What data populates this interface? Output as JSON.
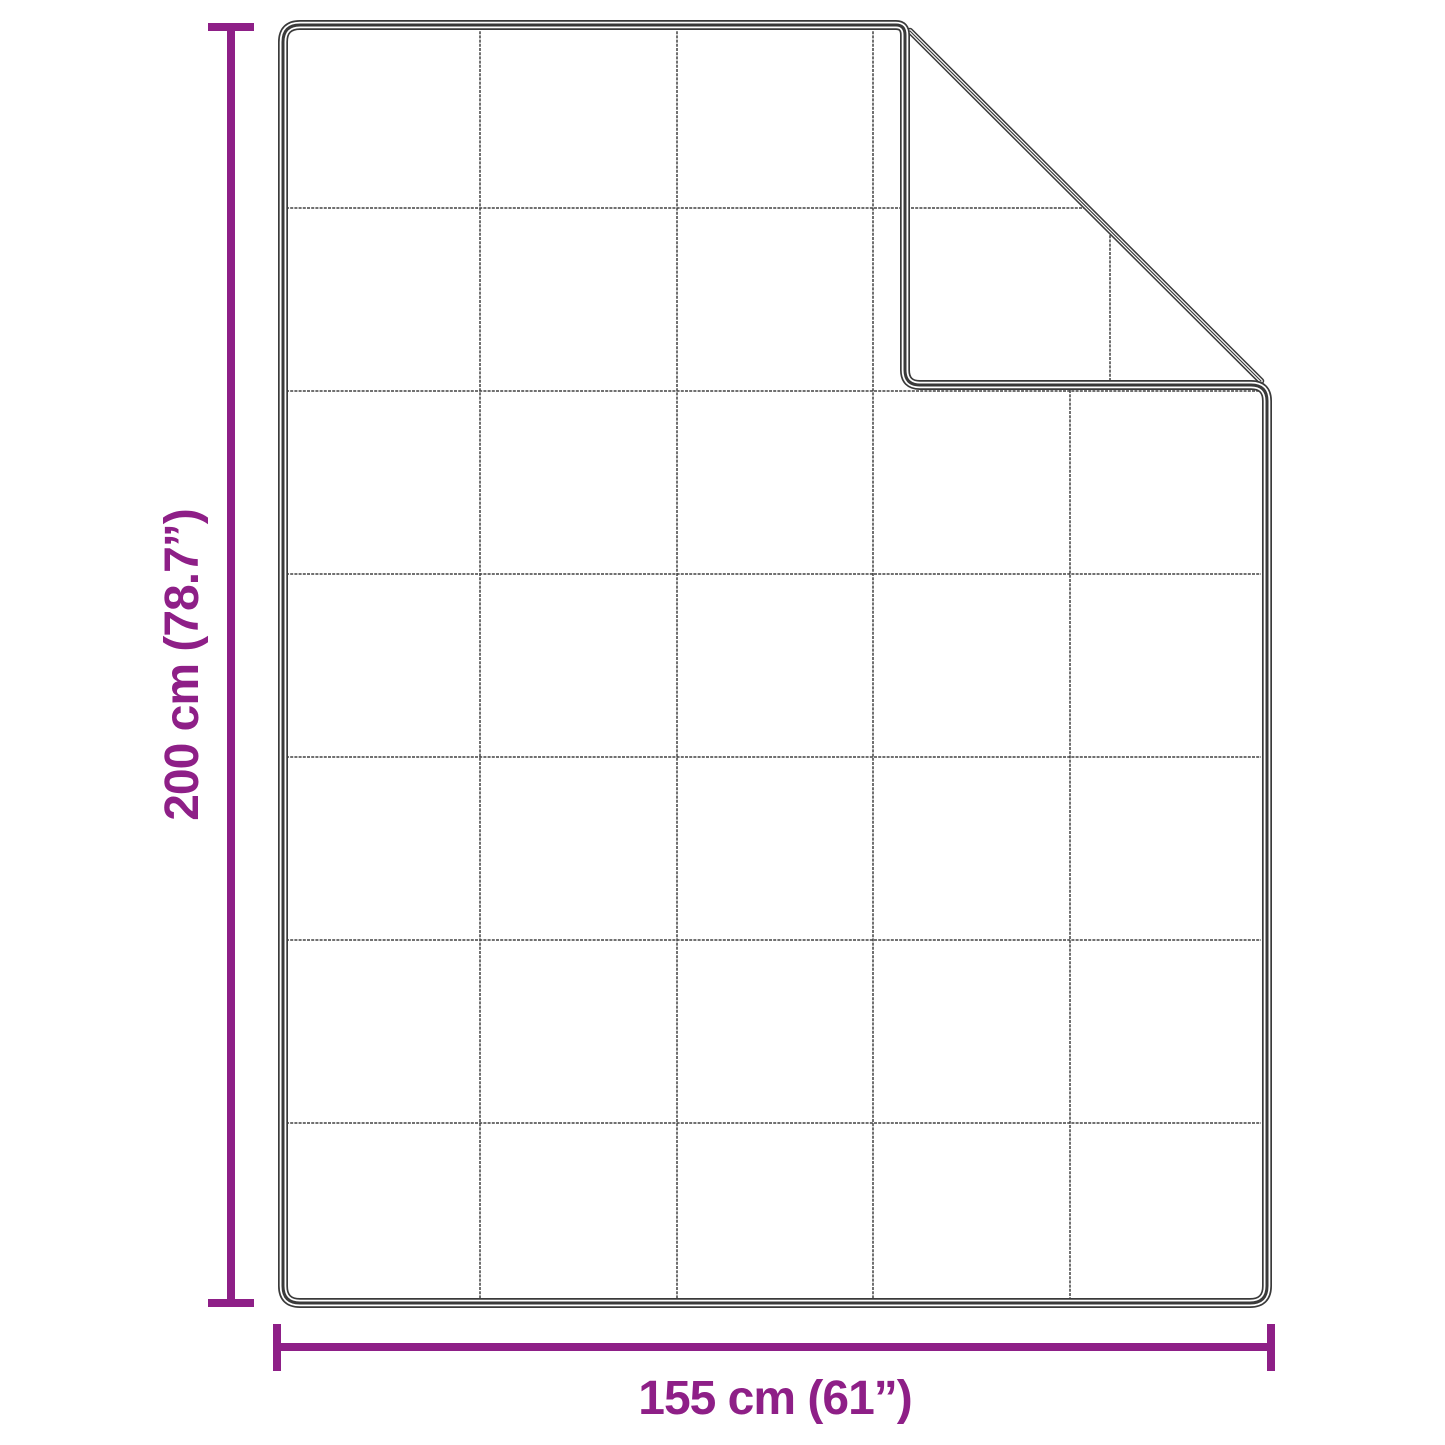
{
  "colors": {
    "accent": "#8e1f87",
    "line": "#3a3a3a",
    "grid": "#424242",
    "bg": "#ffffff"
  },
  "diagram": {
    "type": "product-dimension-diagram",
    "subject": "quilted blanket with folded top-right corner",
    "grid_rows": 7,
    "grid_columns": 5,
    "height_label": "200 cm (78.7”)",
    "width_label": "155 cm (61”)"
  }
}
